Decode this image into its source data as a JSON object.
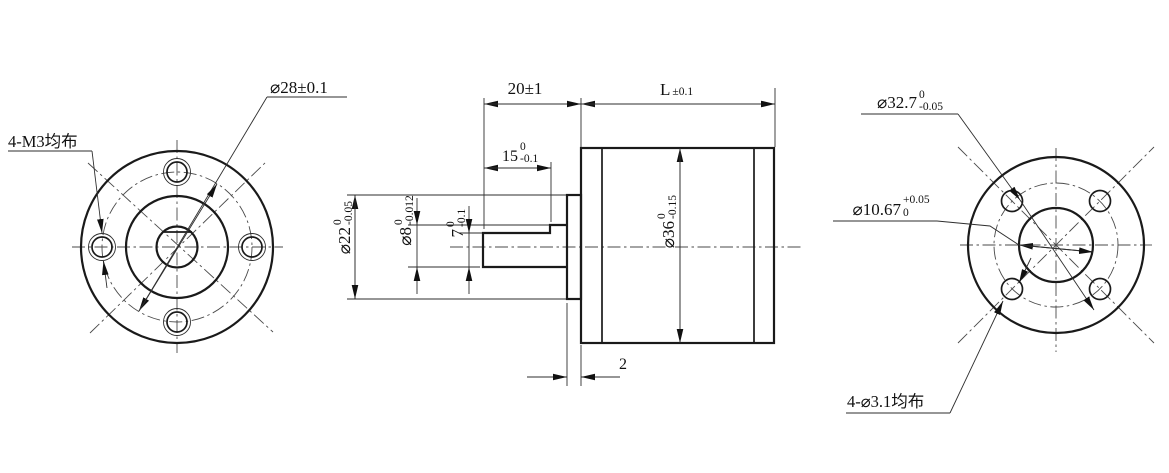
{
  "front_view": {
    "callout_holes": "4-M3均布",
    "dim_bolt_circle": "⌀28±0.1"
  },
  "side_view": {
    "dim_shaft_length": "20±1",
    "dim_body_length": {
      "main": "L",
      "tol": "±0.1"
    },
    "dim_flat_length": {
      "main": "15",
      "upper": "0",
      "lower": "-0.1"
    },
    "dim_boss_dia": {
      "main": "⌀22",
      "upper": "0",
      "lower": "-0.05"
    },
    "dim_shaft_dia": {
      "main": "⌀8",
      "upper": "0",
      "lower": "-0.012"
    },
    "dim_flat_height": {
      "main": "7",
      "upper": "0",
      "lower": "-0.1"
    },
    "dim_body_dia": {
      "main": "⌀36",
      "upper": "0",
      "lower": "-0.15"
    },
    "dim_boss_thickness": "2"
  },
  "rear_view": {
    "dim_bolt_circle": {
      "main": "⌀32.7",
      "upper": "0",
      "lower": "-0.05"
    },
    "dim_center_bore": {
      "main": "⌀10.67",
      "upper": "+0.05",
      "lower": "0"
    },
    "callout_holes": "4-⌀3.1均布"
  }
}
